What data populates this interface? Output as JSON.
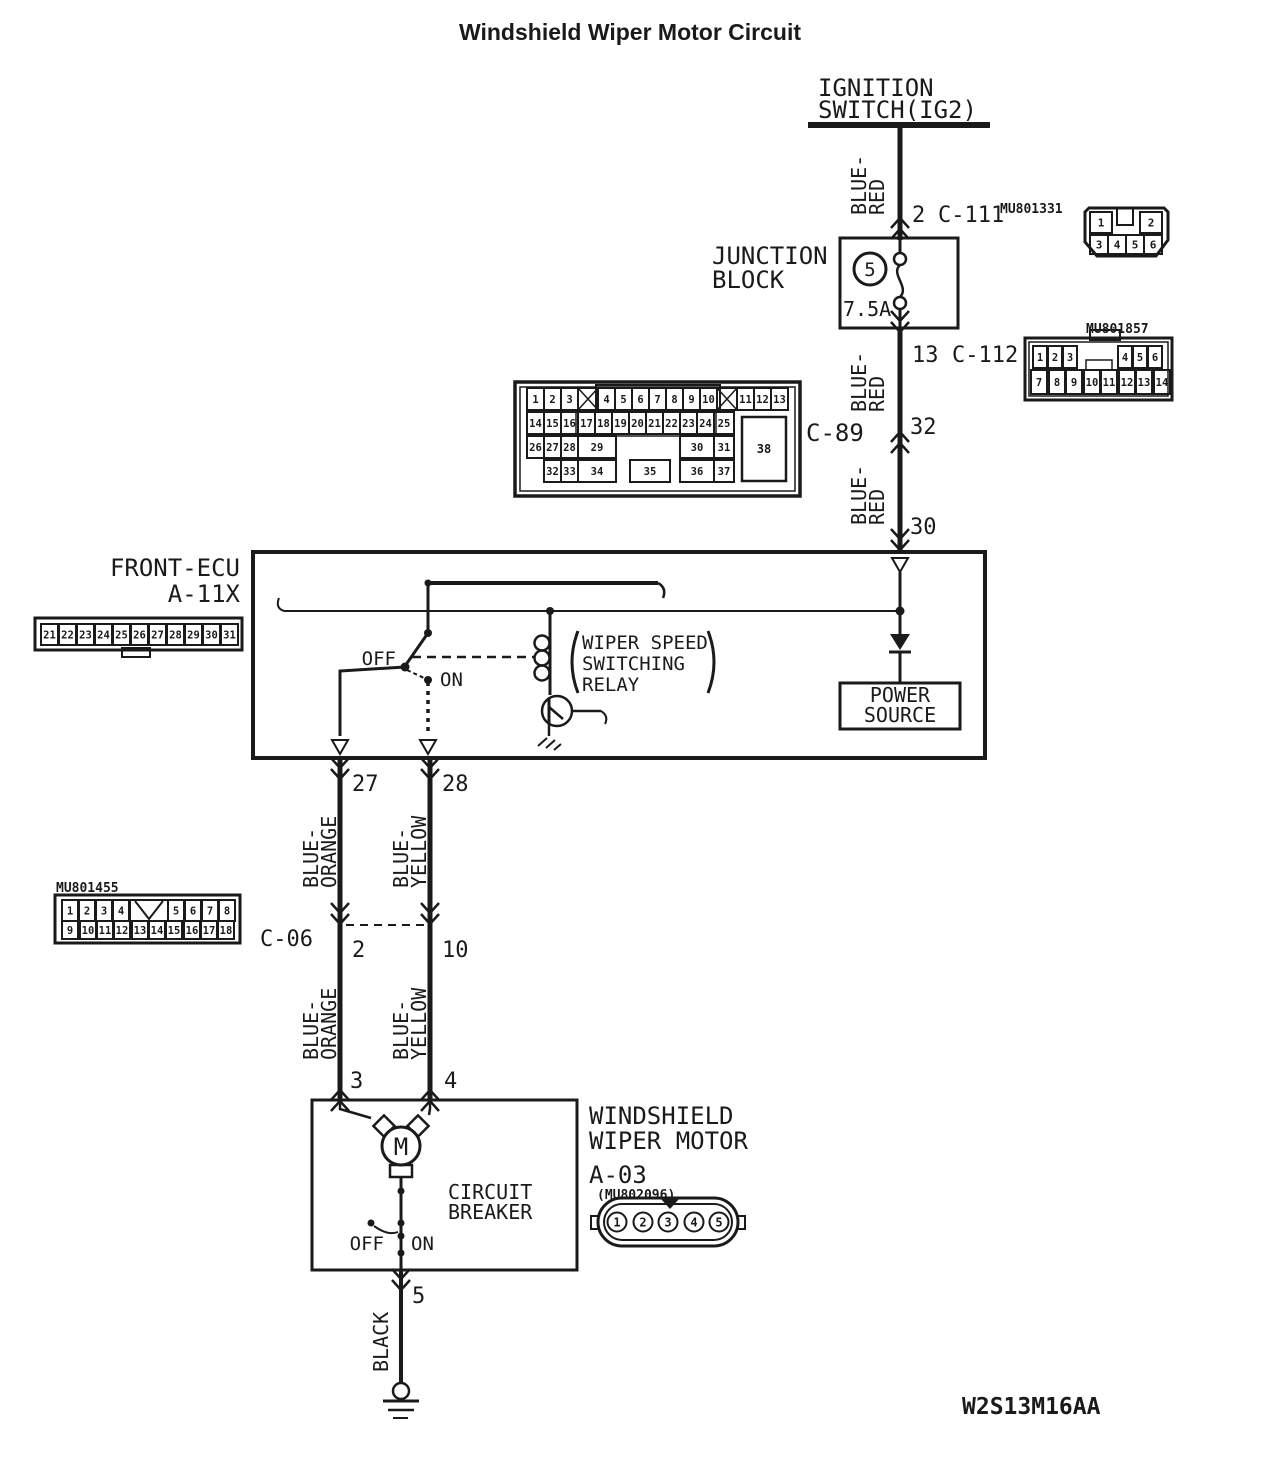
{
  "title": "Windshield Wiper Motor Circuit",
  "footer_code": "W2S13M16AA",
  "ignition": {
    "line1": "IGNITION",
    "line2": "SWITCH(IG2)"
  },
  "junction_block": {
    "line1": "JUNCTION",
    "line2": "BLOCK",
    "fuse_number": "5",
    "fuse_rating": "7.5A"
  },
  "wires": {
    "blue_red": {
      "w1": "BLUE-",
      "w2": "RED"
    },
    "blue_orange": {
      "w1": "BLUE-",
      "w2": "ORANGE"
    },
    "blue_yellow": {
      "w1": "BLUE-",
      "w2": "YELLOW"
    },
    "black": "BLACK"
  },
  "c111": {
    "pin": "2",
    "name": "C-111",
    "part": "MU801331",
    "top": [
      "1",
      "2"
    ],
    "bottom": [
      "3",
      "4",
      "5",
      "6"
    ]
  },
  "c112": {
    "pin": "13",
    "name": "C-112",
    "part": "MU801857",
    "top": [
      "1",
      "2",
      "3",
      "4",
      "5",
      "6"
    ],
    "bottom": [
      "7",
      "8",
      "9",
      "10",
      "11",
      "12",
      "13",
      "14"
    ]
  },
  "c89": {
    "name": "C-89",
    "pin_upper": "32",
    "pin_lower": "30",
    "row1": [
      "1",
      "2",
      "3",
      "4",
      "5",
      "6",
      "7",
      "8",
      "9",
      "10",
      "11",
      "12",
      "13"
    ],
    "row2": [
      "14",
      "15",
      "16",
      "17",
      "18",
      "19",
      "20",
      "21",
      "22",
      "23",
      "24",
      "25"
    ],
    "row3": [
      "26",
      "27",
      "28",
      "29",
      "30",
      "31"
    ],
    "row4": [
      "32",
      "33",
      "34",
      "35",
      "36",
      "37"
    ],
    "big": "38"
  },
  "ecu": {
    "name": "FRONT-ECU",
    "ref": "A-11X",
    "strip": [
      "21",
      "22",
      "23",
      "24",
      "25",
      "26",
      "27",
      "28",
      "29",
      "30",
      "31"
    ],
    "off": "OFF",
    "on": "ON",
    "relay": {
      "line1": "WIPER SPEED",
      "line2": "SWITCHING",
      "line3": "RELAY"
    },
    "power_source": {
      "line1": "POWER",
      "line2": "SOURCE"
    },
    "pin27": "27",
    "pin28": "28"
  },
  "c06": {
    "name": "C-06",
    "part": "MU801455",
    "pin_left": "2",
    "pin_right": "10",
    "top": [
      "1",
      "2",
      "3",
      "4",
      "5",
      "6",
      "7",
      "8"
    ],
    "bottom": [
      "9",
      "10",
      "11",
      "12",
      "13",
      "14",
      "15",
      "16",
      "17",
      "18"
    ]
  },
  "motor": {
    "name_line1": "WINDSHIELD",
    "name_line2": "WIPER MOTOR",
    "ref": "A-03",
    "part": "(MU802096)",
    "pins": [
      "1",
      "2",
      "3",
      "4",
      "5"
    ],
    "pin3": "3",
    "pin4": "4",
    "pin5": "5",
    "motor_letter": "M",
    "breaker_line1": "CIRCUIT",
    "breaker_line2": "BREAKER",
    "off": "OFF",
    "on": "ON"
  }
}
